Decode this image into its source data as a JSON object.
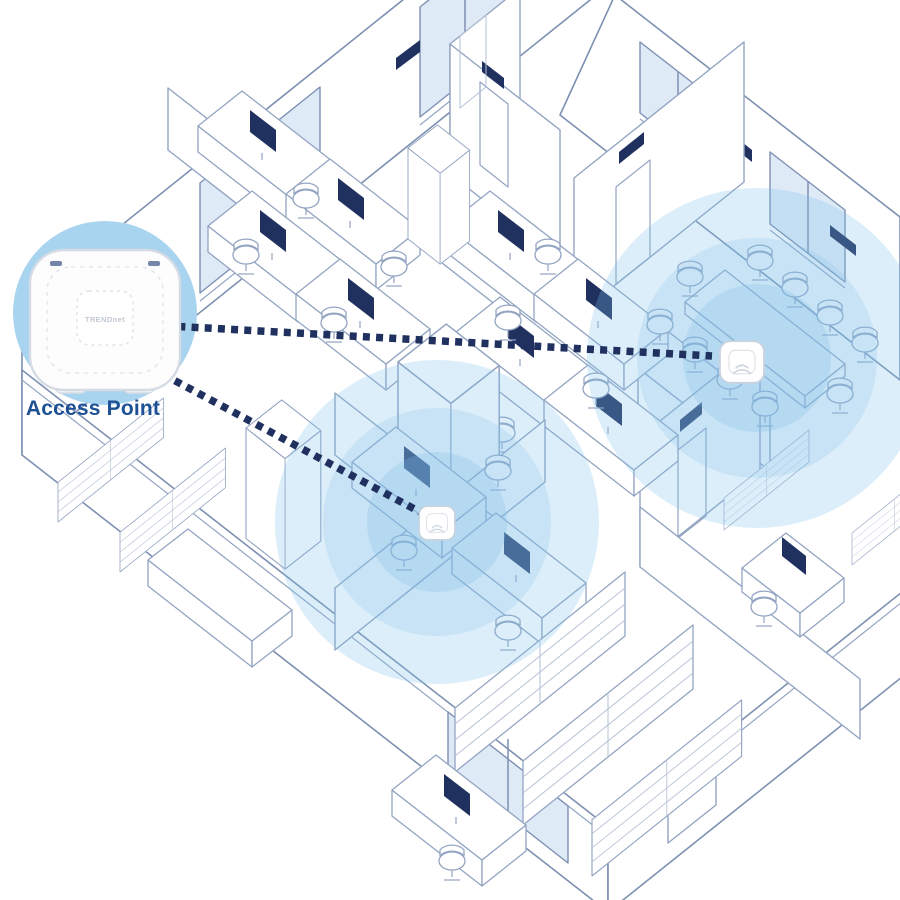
{
  "diagram": {
    "label_access_point": "Access Point",
    "device_brand": "TRENDnet"
  },
  "colors": {
    "background": "#ffffff",
    "line": "#93a4c2",
    "line_dark": "#7d90b2",
    "line_light": "#b6c2d6",
    "navy": "#203160",
    "label_blue": "#1d5094",
    "wall_fill": "#ffffff",
    "glass": "#dfeaf7",
    "wifi": "#7fbfe8",
    "hero_circle": "#a9d4f0",
    "device_body": "#fdfdfd",
    "device_edge": "#d5dbe4"
  },
  "coverage_zones": [
    {
      "name": "meeting-area",
      "cx": 437,
      "cy": 522,
      "rings": [
        {
          "r": 162,
          "o": 0.27
        },
        {
          "r": 114,
          "o": 0.22
        },
        {
          "r": 70,
          "o": 0.26
        }
      ]
    },
    {
      "name": "conference-room",
      "cx": 757,
      "cy": 358,
      "rings": [
        {
          "r": 170,
          "o": 0.27
        },
        {
          "r": 120,
          "o": 0.22
        },
        {
          "r": 74,
          "o": 0.26
        }
      ]
    }
  ],
  "connections": [
    {
      "name": "ap-to-conference",
      "x1": 152,
      "y1": 325,
      "x2": 712,
      "y2": 356
    },
    {
      "name": "ap-to-meeting",
      "x1": 140,
      "y1": 362,
      "x2": 420,
      "y2": 512
    }
  ],
  "devices": [
    {
      "name": "ceiling-ap-meeting",
      "x": 437,
      "y": 523,
      "scale": 1.05
    },
    {
      "name": "ceiling-ap-conference",
      "x": 742,
      "y": 362,
      "scale": 1.3
    }
  ]
}
